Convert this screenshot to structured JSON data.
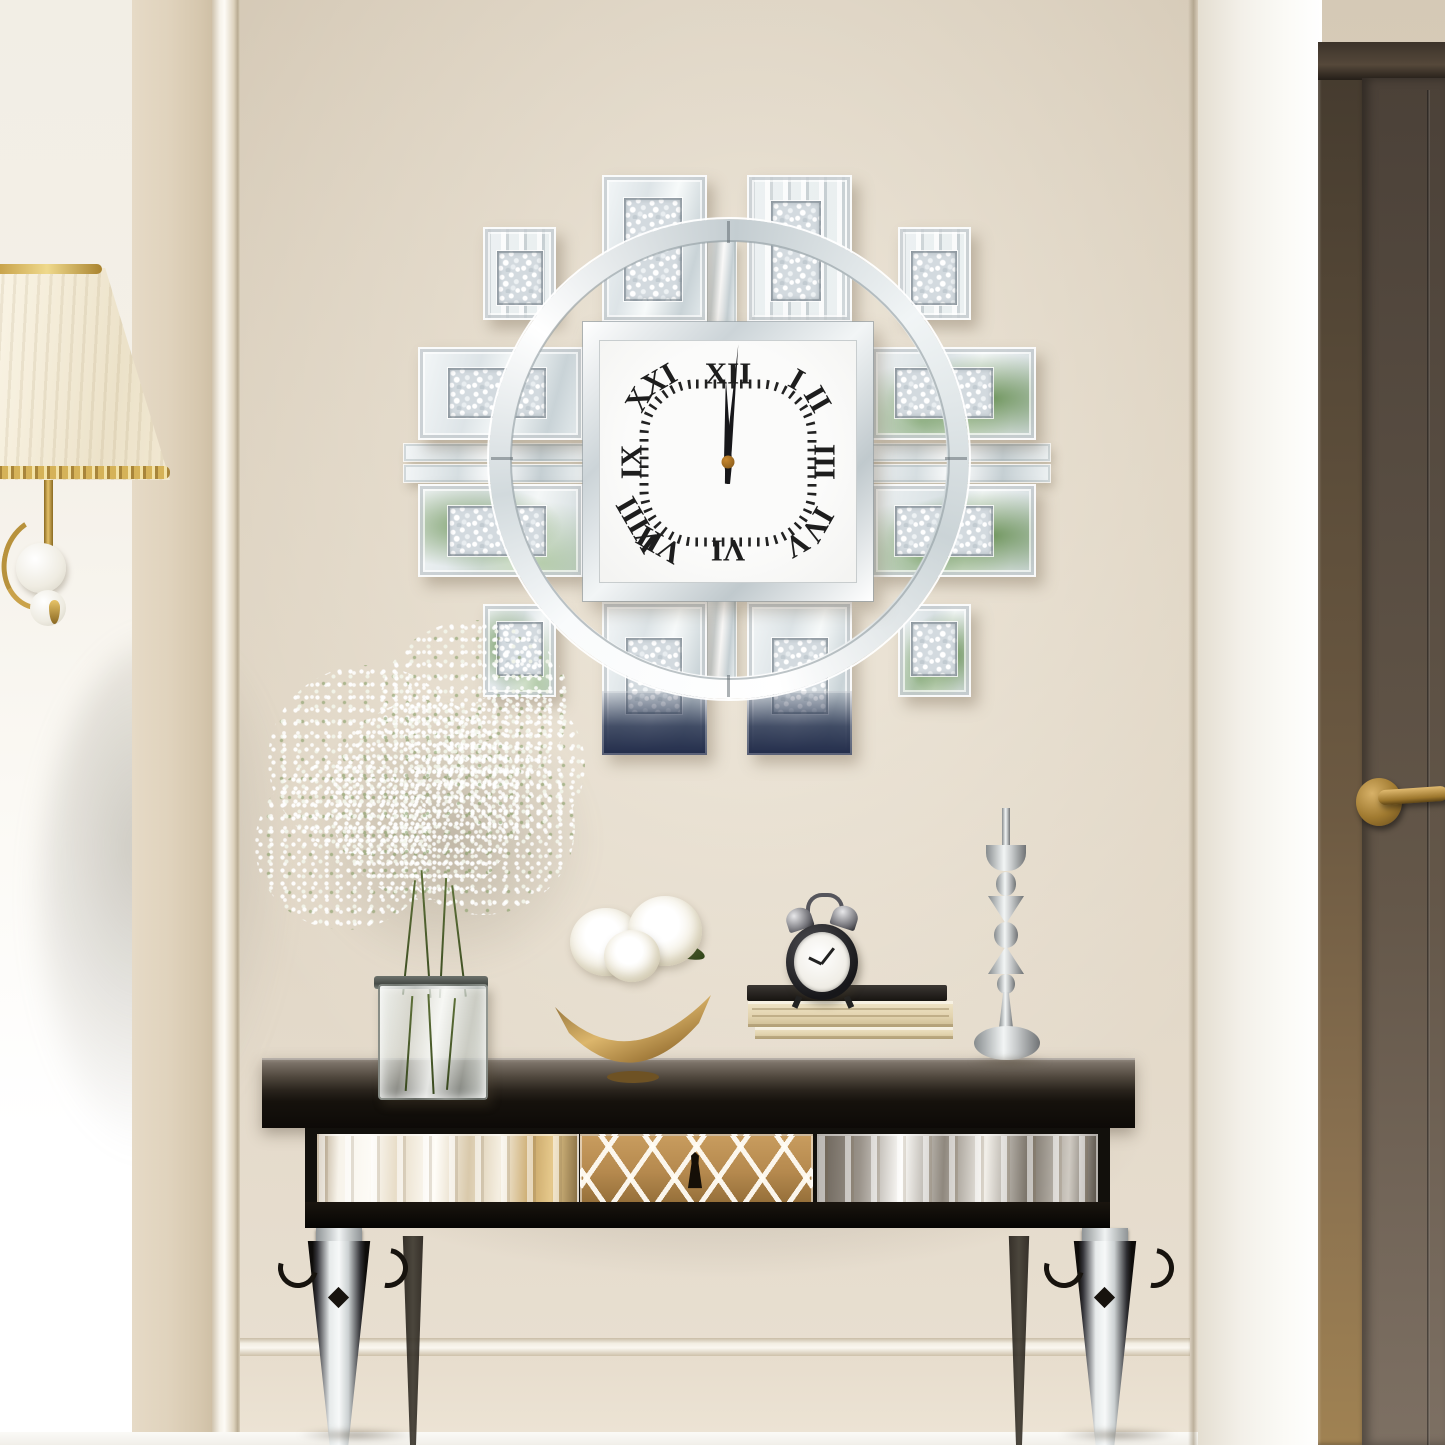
{
  "scene": {
    "setting": "hallway interior with wall clock above console table",
    "objects": {
      "wall_clock": "mirrored crushed-crystal wall clock",
      "console_table": "mirrored console table with lattice drawer",
      "lamp": "pleated cream lamp with brass arm",
      "door": "dark bronze interior door with brass lever handle",
      "vase": "glass vase with baby's breath flowers",
      "bowl": "gold crescent bowl with white peonies",
      "books": "stacked books",
      "alarm_clock": "twin-bell black alarm clock",
      "candlestick": "silver geometric candlestick"
    }
  },
  "clock": {
    "numerals": [
      "XII",
      "I",
      "II",
      "III",
      "IV",
      "V",
      "VI",
      "VII",
      "VIII",
      "IX",
      "X",
      "XI"
    ],
    "time": "12:00",
    "hand_angles": {
      "minute_deg": 5,
      "hour_deg": -1.5
    },
    "tick_count": 64,
    "numeral_color": "#1d1d1d",
    "hand_color": "#17171a",
    "center_cap_color": "#c9882e",
    "face_color": "#fbfbfa"
  },
  "palette": {
    "wall_beige": "#ddd2c1",
    "wall_beige_light": "#eae1d3",
    "side_wall_light": "#f6f3ec",
    "molding_white": "#f4f0e7",
    "right_panel_white": "#f5f3ed",
    "door_frame_bronze": "#6e5b42",
    "door_brown": "#5c5045",
    "handle_brass": "#b08a3c",
    "mirror_silver": "#e9eef0",
    "crystal_fill": "#d8dfe3",
    "reflection_green": "#5f8f45",
    "reflection_navy": "#2e3a56",
    "table_black": "#1a150f",
    "drawer_gold": "#b5894e",
    "book_cream": "#e9dcba",
    "lamp_cream": "#f5eeda",
    "lamp_gold": "#c9a24a",
    "floor_white": "#f7f6f2"
  }
}
